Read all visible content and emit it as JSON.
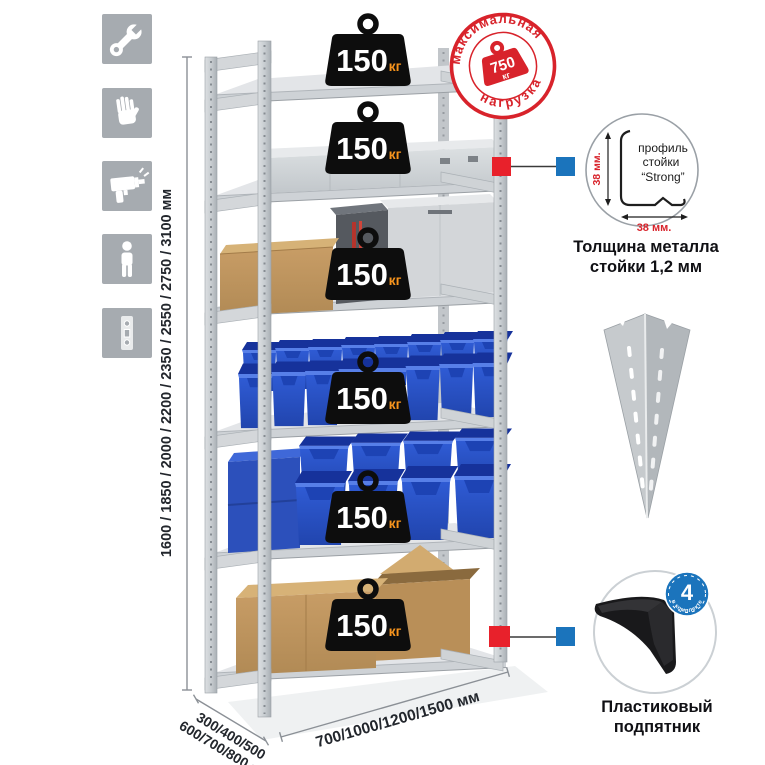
{
  "sidebar_icons": [
    {
      "name": "wrench"
    },
    {
      "name": "work-gloves"
    },
    {
      "name": "drill"
    },
    {
      "name": "person"
    },
    {
      "name": "perforated-post"
    }
  ],
  "height_dim": {
    "label": "1600 / 1850 / 2000 / 2200 / 2350 / 2550 / 2750 / 3100 мм"
  },
  "shelf_badge": {
    "value": "150",
    "unit": "кг"
  },
  "stamp": {
    "top": "максимальная",
    "bottom": "нагрузка",
    "value": "750",
    "unit": "кг"
  },
  "profile": {
    "label1": "профиль",
    "label2": "стойки",
    "label3": "“Strong”",
    "dim_v": "38 мм.",
    "dim_h": "38 мм.",
    "caption1": "Толщина металла",
    "caption2": "стойки 1,2 мм"
  },
  "foot": {
    "badge_number": "4",
    "badge_ring_text": "в комплекте",
    "caption1": "Пластиковый",
    "caption2": "подпятник"
  },
  "depth_dim": {
    "line1": "300/400/500",
    "line2": "600/700/800 мм"
  },
  "width_dim": {
    "label": "700/1000/1200/1500 мм"
  },
  "colors": {
    "accent_red": "#d8232b",
    "accent_blue": "#1b74bc",
    "badge_black": "#0d0d0d",
    "badge_unit_orange": "#f7941d",
    "bin_blue": "#2a55cc",
    "metal_gray": "#a6abb0"
  }
}
